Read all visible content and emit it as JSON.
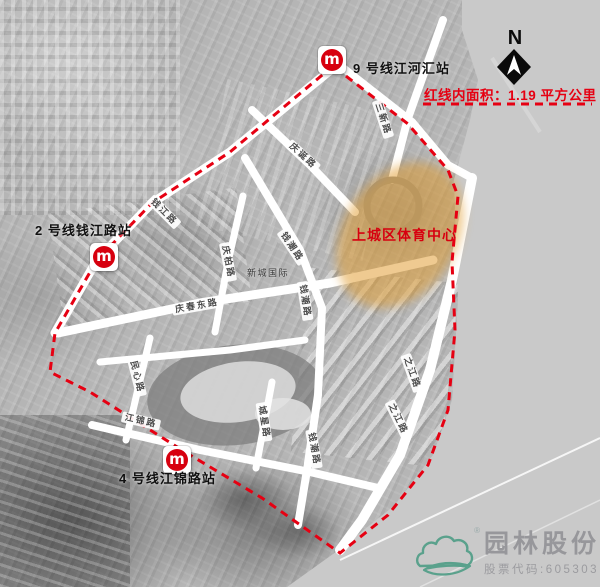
{
  "annotations": {
    "area_note": "红线内面积：1.19 平方公里",
    "sports_center": "上城区体育中心",
    "place_complex": "新城国际",
    "north_label": "N"
  },
  "stations": [
    {
      "label": "9 号线江河汇站",
      "logo_glyph": "m"
    },
    {
      "label": "2 号线钱江路站",
      "logo_glyph": "m"
    },
    {
      "label": "4 号线江锦路站",
      "logo_glyph": "m"
    }
  ],
  "roads": [
    "三新路",
    "庆诞路",
    "钱江路",
    "钱潮路",
    "庆柏路",
    "庆春东路",
    "民心路",
    "江锦路",
    "钱潮路",
    "城星路",
    "钱潮路",
    "之江路",
    "之江路"
  ],
  "watermark": {
    "company": "园林股份",
    "stock_code": "股票代码:605303",
    "registered": "®"
  },
  "colors": {
    "red_line": "#e60012",
    "metro_red": "#d7000f",
    "highlight_orange": "#e2a038",
    "river_gray": "#c9c9c9",
    "watermark_green": "#5aa18c"
  }
}
